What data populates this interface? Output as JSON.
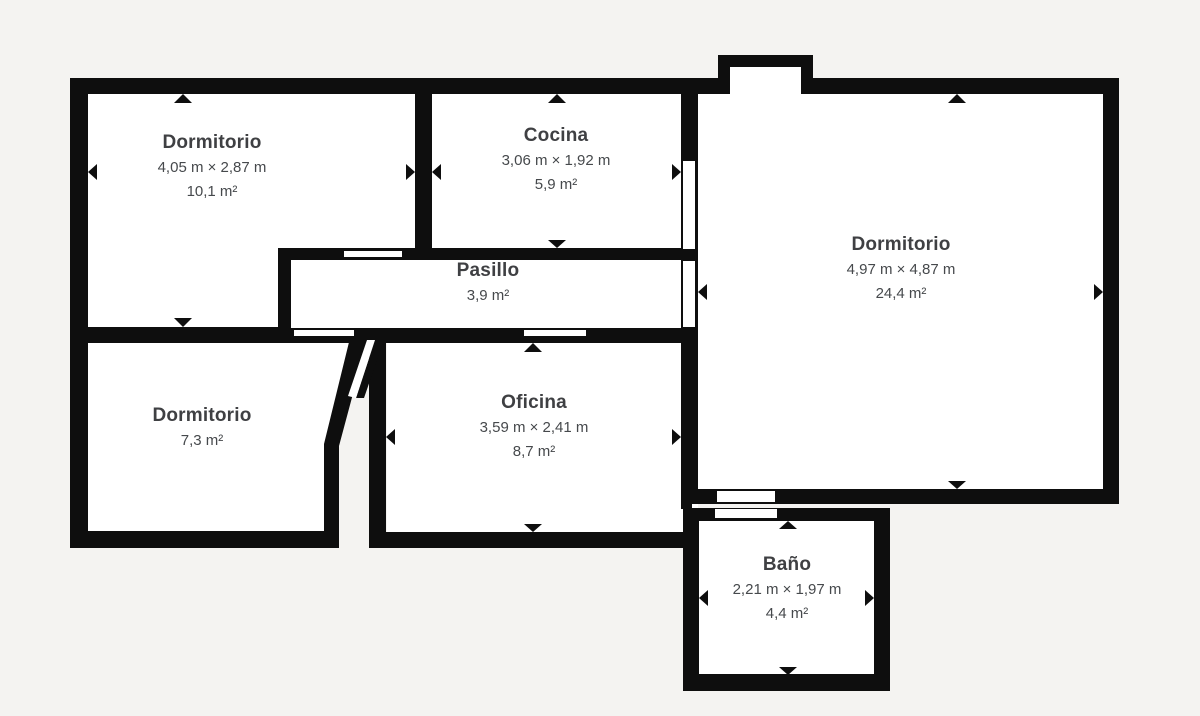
{
  "plan": {
    "rooms": [
      {
        "id": "dormitorio-1",
        "name": "Dormitorio",
        "dimensions": "4,05 m × 2,87 m",
        "area": "10,1 m²"
      },
      {
        "id": "cocina",
        "name": "Cocina",
        "dimensions": "3,06 m × 1,92 m",
        "area": "5,9 m²"
      },
      {
        "id": "dormitorio-2",
        "name": "Dormitorio",
        "dimensions": "4,97 m × 4,87 m",
        "area": "24,4 m²"
      },
      {
        "id": "pasillo",
        "name": "Pasillo",
        "dimensions": "",
        "area": "3,9 m²"
      },
      {
        "id": "dormitorio-3",
        "name": "Dormitorio",
        "dimensions": "",
        "area": "7,3 m²"
      },
      {
        "id": "oficina",
        "name": "Oficina",
        "dimensions": "3,59 m × 2,41 m",
        "area": "8,7 m²"
      },
      {
        "id": "bano",
        "name": "Baño",
        "dimensions": "2,21 m × 1,97 m",
        "area": "4,4 m²"
      }
    ],
    "colors": {
      "wall": "#0e0e0e",
      "background": "#f4f3f1",
      "room_fill": "#ffffff",
      "text": "#3f4043"
    },
    "icons": {
      "dimension_arrow": "small solid triangle pointing at measured wall"
    }
  }
}
